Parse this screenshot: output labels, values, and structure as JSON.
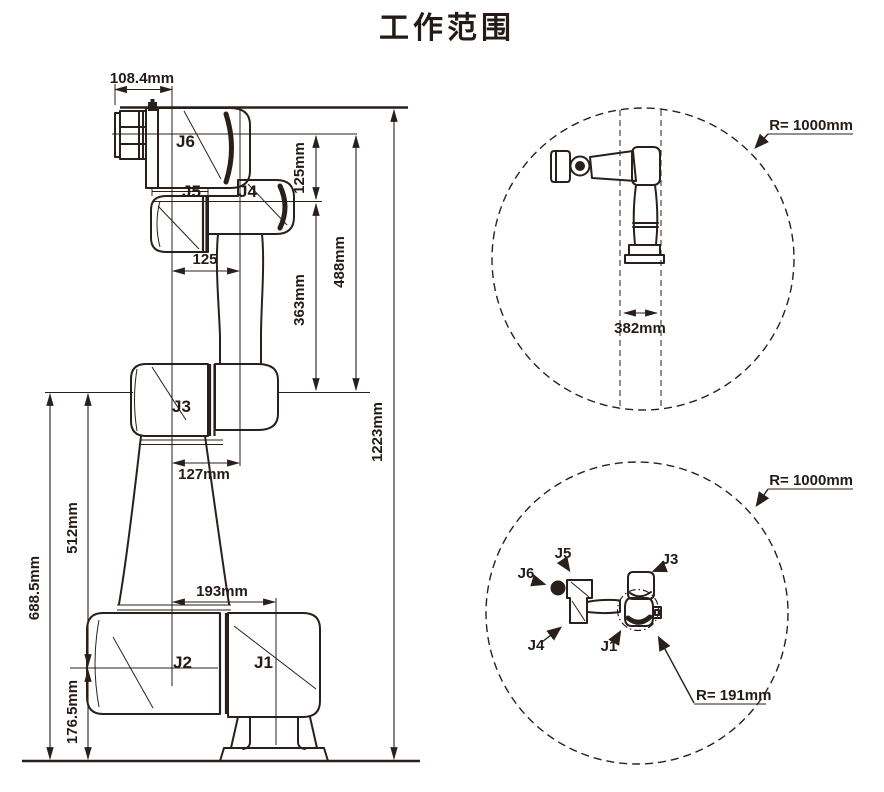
{
  "title": "工作范围",
  "front_view": {
    "joint_labels": {
      "j1": "J1",
      "j2": "J2",
      "j3": "J3",
      "j4": "J4",
      "j5": "J5",
      "j6": "J6"
    },
    "dimensions": {
      "top_width": "108.4mm",
      "flange_to_j4_axis": "125mm",
      "j4_to_j3_axis": "363mm",
      "flange_to_j3_axis": "488mm",
      "total_height": "1223mm",
      "wrist_to_arm_offset": "125",
      "arm_to_forearm_offset": "127mm",
      "forearm_to_j1_offset": "193mm",
      "j3_axis_height": "688.5mm",
      "j3_to_j2_axis": "512mm",
      "j2_axis_height": "176.5mm"
    }
  },
  "side_envelope_view": {
    "reach_radius": "R= 1000mm",
    "column_width": "382mm"
  },
  "top_envelope_view": {
    "reach_radius": "R= 1000mm",
    "wrist_turn_radius": "R= 191mm",
    "joint_labels": {
      "j1": "J1",
      "j3": "J3",
      "j4": "J4",
      "j5": "J5",
      "j6": "J6"
    }
  }
}
